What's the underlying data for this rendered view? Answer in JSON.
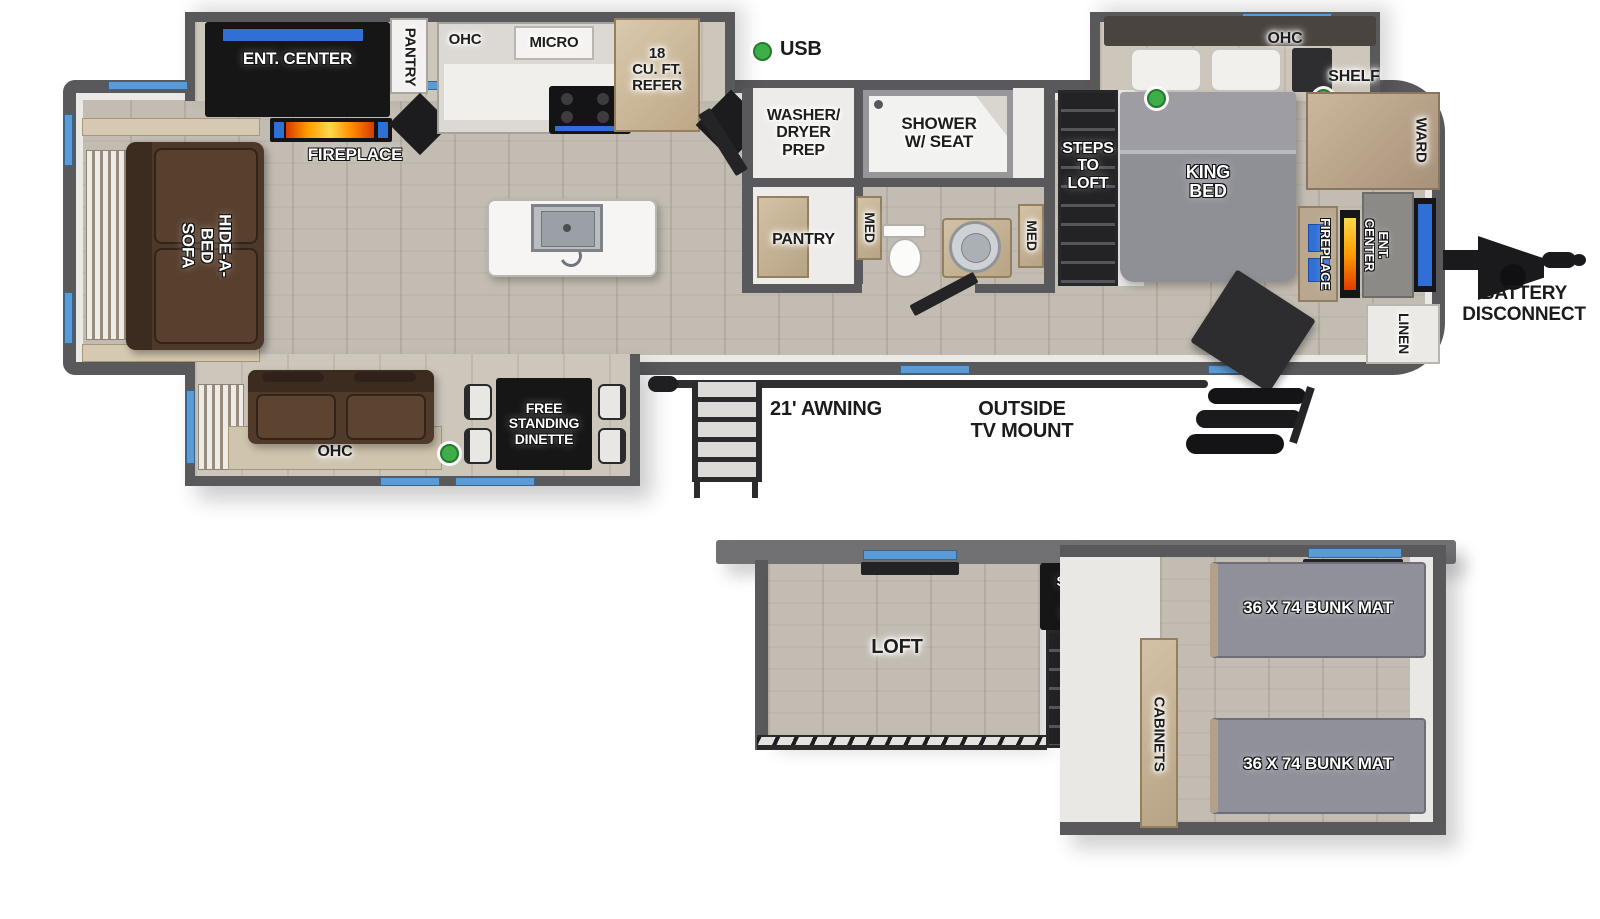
{
  "diagram_type": "rv-floorplan",
  "palette": {
    "wall": "#59595b",
    "floor_wood": "#c2bcb2",
    "interior_white": "#ebe9e5",
    "black_feature": "#161617",
    "window_blue": "#5b9bd5",
    "usb_green": "#3fae49",
    "sofa_brown": "#4e382a",
    "cabinet_tan": "#c4b294",
    "bunk_mat_gray": "#90909a",
    "flame_orange": "#ff8a00"
  },
  "main_floor": {
    "living_slide": {
      "ent_center": "ENT. CENTER",
      "pantry": "PANTRY",
      "ohc": "OHC",
      "micro": "MICRO",
      "refer": "18\nCU. FT.\nREFER"
    },
    "living": {
      "fireplace": "FIREPLACE",
      "sofa": "HIDE-A-BED\nSOFA"
    },
    "utility": {
      "washer_dryer": "WASHER/\nDRYER\nPREP",
      "pantry": "PANTRY"
    },
    "bath": {
      "shower": "SHOWER\nW/ SEAT",
      "med_left": "MED",
      "med_right": "MED"
    },
    "steps_to_loft": "STEPS\nTO\nLOFT",
    "bedroom": {
      "ohc": "OHC",
      "shelf": "SHELF",
      "king_bed": "KING\nBED",
      "ward": "WARD",
      "fireplace": "FIREPLACE",
      "ent_center": "ENT. CENTER",
      "linen": "LINEN"
    },
    "garage_slide": {
      "ohc": "OHC",
      "dinette": "FREE\nSTANDING\nDINETTE"
    },
    "exterior": {
      "usb": "USB",
      "awning": "21' AWNING",
      "tv_mount": "OUTSIDE\nTV MOUNT",
      "battery": "BATTERY\nDISCONNECT"
    }
  },
  "lower_floor": {
    "loft": "LOFT",
    "steps_to_loft": "STEPS\nTO\nLOFT",
    "cabinets": "CABINETS",
    "bunk_mat_top": "36 X 74 BUNK MAT",
    "bunk_mat_bottom": "36 X 74 BUNK MAT"
  }
}
